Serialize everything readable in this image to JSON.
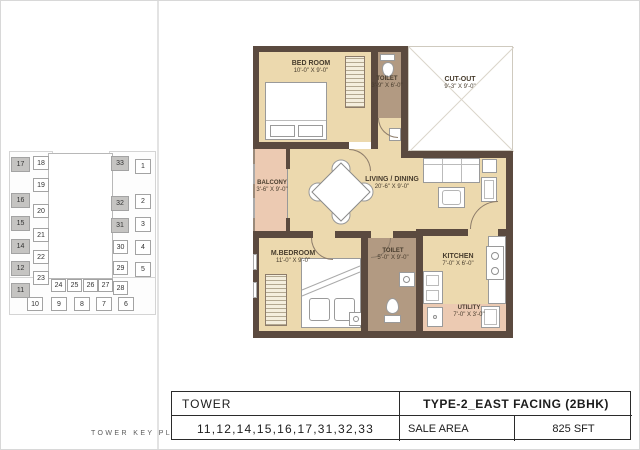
{
  "key_plan": {
    "caption": "TOWER KEY PLAN",
    "highlight_color": "#c5c4c2",
    "units": [
      {
        "label": "17",
        "x": 10,
        "y": 156,
        "w": 19,
        "h": 15,
        "hl": true
      },
      {
        "label": "16",
        "x": 10,
        "y": 192,
        "w": 19,
        "h": 15,
        "hl": true
      },
      {
        "label": "15",
        "x": 10,
        "y": 215,
        "w": 19,
        "h": 15,
        "hl": true
      },
      {
        "label": "14",
        "x": 10,
        "y": 238,
        "w": 19,
        "h": 15,
        "hl": true
      },
      {
        "label": "12",
        "x": 10,
        "y": 260,
        "w": 19,
        "h": 15,
        "hl": true
      },
      {
        "label": "11",
        "x": 10,
        "y": 282,
        "w": 19,
        "h": 15,
        "hl": true
      },
      {
        "label": "18",
        "x": 32,
        "y": 155,
        "w": 16,
        "h": 14,
        "hl": false
      },
      {
        "label": "19",
        "x": 32,
        "y": 177,
        "w": 16,
        "h": 14,
        "hl": false
      },
      {
        "label": "20",
        "x": 32,
        "y": 203,
        "w": 16,
        "h": 14,
        "hl": false
      },
      {
        "label": "21",
        "x": 32,
        "y": 227,
        "w": 16,
        "h": 14,
        "hl": false
      },
      {
        "label": "22",
        "x": 32,
        "y": 249,
        "w": 16,
        "h": 14,
        "hl": false
      },
      {
        "label": "23",
        "x": 32,
        "y": 270,
        "w": 16,
        "h": 14,
        "hl": false
      },
      {
        "label": "24",
        "x": 50,
        "y": 278,
        "w": 15,
        "h": 13,
        "hl": false
      },
      {
        "label": "25",
        "x": 66,
        "y": 278,
        "w": 15,
        "h": 13,
        "hl": false
      },
      {
        "label": "26",
        "x": 82,
        "y": 278,
        "w": 15,
        "h": 13,
        "hl": false
      },
      {
        "label": "27",
        "x": 97,
        "y": 278,
        "w": 15,
        "h": 13,
        "hl": false
      },
      {
        "label": "33",
        "x": 110,
        "y": 155,
        "w": 18,
        "h": 15,
        "hl": true
      },
      {
        "label": "32",
        "x": 110,
        "y": 195,
        "w": 18,
        "h": 15,
        "hl": true
      },
      {
        "label": "31",
        "x": 110,
        "y": 217,
        "w": 18,
        "h": 15,
        "hl": true
      },
      {
        "label": "30",
        "x": 112,
        "y": 239,
        "w": 15,
        "h": 14,
        "hl": false
      },
      {
        "label": "29",
        "x": 112,
        "y": 260,
        "w": 15,
        "h": 14,
        "hl": false
      },
      {
        "label": "28",
        "x": 112,
        "y": 280,
        "w": 15,
        "h": 14,
        "hl": false
      },
      {
        "label": "1",
        "x": 134,
        "y": 158,
        "w": 16,
        "h": 15,
        "hl": false
      },
      {
        "label": "2",
        "x": 134,
        "y": 193,
        "w": 16,
        "h": 15,
        "hl": false
      },
      {
        "label": "3",
        "x": 134,
        "y": 216,
        "w": 16,
        "h": 15,
        "hl": false
      },
      {
        "label": "4",
        "x": 134,
        "y": 239,
        "w": 16,
        "h": 15,
        "hl": false
      },
      {
        "label": "5",
        "x": 134,
        "y": 261,
        "w": 16,
        "h": 15,
        "hl": false
      },
      {
        "label": "10",
        "x": 26,
        "y": 296,
        "w": 16,
        "h": 14,
        "hl": false
      },
      {
        "label": "9",
        "x": 50,
        "y": 296,
        "w": 16,
        "h": 14,
        "hl": false
      },
      {
        "label": "8",
        "x": 73,
        "y": 296,
        "w": 16,
        "h": 14,
        "hl": false
      },
      {
        "label": "7",
        "x": 95,
        "y": 296,
        "w": 16,
        "h": 14,
        "hl": false
      },
      {
        "label": "6",
        "x": 117,
        "y": 296,
        "w": 16,
        "h": 14,
        "hl": false
      }
    ]
  },
  "floor_plan": {
    "rooms": {
      "bedroom": {
        "name": "BED ROOM",
        "dims": "10'-0\" X 9'-0\""
      },
      "toilet_top": {
        "name": "TOILET",
        "dims": "3'-9\" X 6'-0\""
      },
      "cutout": {
        "name": "CUT-OUT",
        "dims": "9'-3\" X 9'-0\""
      },
      "balcony": {
        "name": "BALCONY",
        "dims": "3'-6\" X 9'-0\""
      },
      "living": {
        "name": "LIVING / DINING",
        "dims": "20'-6\" X 9'-0\""
      },
      "mbedroom": {
        "name": "M.BEDROOM",
        "dims": "11'-0\" X 9'-0\""
      },
      "toilet_bottom": {
        "name": "TOILET",
        "dims": "5'-0\" X 9'-0\""
      },
      "kitchen": {
        "name": "KITCHEN",
        "dims": "7'-0\" X 6'-0\""
      },
      "utility": {
        "name": "UTILITY",
        "dims": "7'-0\" X 3'-0\""
      }
    }
  },
  "info_table": {
    "tower_label": "TOWER",
    "type_label": "TYPE-2_EAST FACING (2BHK)",
    "tower_numbers": "11,12,14,15,16,17,31,32,33",
    "sale_area_label": "SALE AREA",
    "sale_area_value": "825 SFT"
  },
  "colors": {
    "wall": "#5b4a3f",
    "floor": "#ecd9ae",
    "balcony_floor": "#eccab2",
    "toilet_floor": "#b29a82",
    "highlight": "#c5c4c2"
  }
}
